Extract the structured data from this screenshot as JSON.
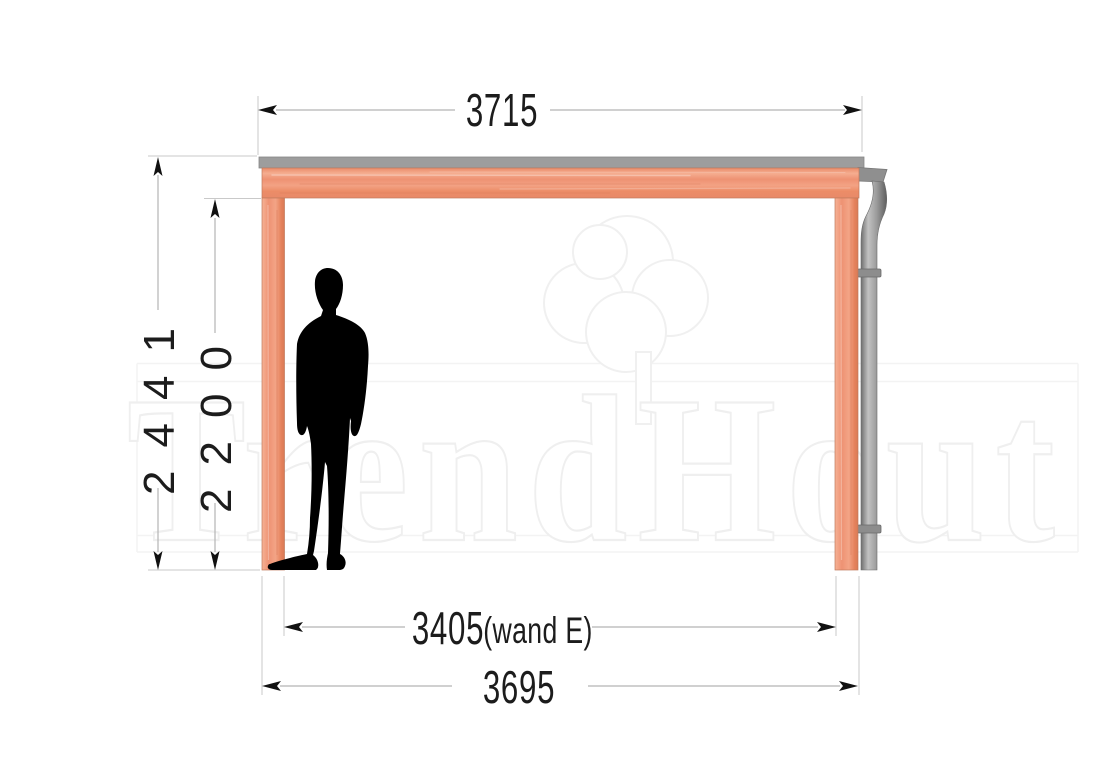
{
  "watermark": {
    "brand": "TrendHout",
    "logo": "tree-icon",
    "color": "#f0f0f0"
  },
  "drawing": {
    "type": "side-elevation-veranda",
    "parts": [
      "roof-edge-profile",
      "fascia-beam",
      "post-left",
      "post-right",
      "gutter-end-cap",
      "downspout-pipe",
      "human-silhouette"
    ],
    "wood_color": "#f09a7c",
    "roof_color": "#9d9d9d",
    "pipe_color": "#8f8f8f"
  },
  "dimensions": {
    "top_width": {
      "value": "3715"
    },
    "overall_height": {
      "value": "2441"
    },
    "clear_height": {
      "value": "2200"
    },
    "wall_width": {
      "value": "3405",
      "suffix": "(wand E)"
    },
    "bottom_width": {
      "value": "3695"
    },
    "line_color": "#b4b4b4",
    "text_color": "#1c1c1c"
  }
}
